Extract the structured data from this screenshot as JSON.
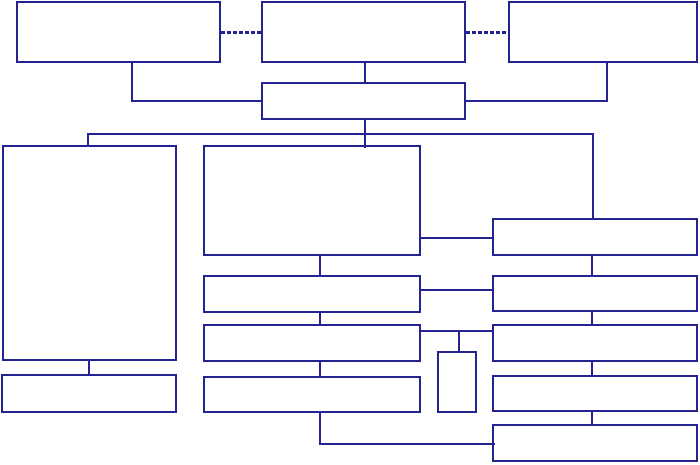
{
  "canvas": {
    "width": 700,
    "height": 465,
    "background_color": "#ffffff"
  },
  "style": {
    "stroke_color": "#232391",
    "box_fill_color": "#ffffff",
    "line_thickness": 2,
    "dash_thickness": 3,
    "dash_length": 4,
    "dash_gap": 2
  },
  "boxes": [
    {
      "name": "box-top-left",
      "x": 16,
      "y": 1,
      "w": 205,
      "h": 62
    },
    {
      "name": "box-top-middle",
      "x": 261,
      "y": 1,
      "w": 205,
      "h": 62
    },
    {
      "name": "box-top-right",
      "x": 508,
      "y": 1,
      "w": 190,
      "h": 62
    },
    {
      "name": "box-level2-center",
      "x": 261,
      "y": 82,
      "w": 205,
      "h": 38
    },
    {
      "name": "box-left-large",
      "x": 2,
      "y": 145,
      "w": 175,
      "h": 216
    },
    {
      "name": "box-left-bottom",
      "x": 1,
      "y": 374,
      "w": 176,
      "h": 39
    },
    {
      "name": "box-middle-large",
      "x": 203,
      "y": 145,
      "w": 218,
      "h": 111
    },
    {
      "name": "box-middle-2",
      "x": 203,
      "y": 275,
      "w": 218,
      "h": 38
    },
    {
      "name": "box-middle-3",
      "x": 203,
      "y": 324,
      "w": 218,
      "h": 38
    },
    {
      "name": "box-middle-4",
      "x": 203,
      "y": 376,
      "w": 218,
      "h": 37
    },
    {
      "name": "box-small-center",
      "x": 437,
      "y": 351,
      "w": 40,
      "h": 62
    },
    {
      "name": "box-right-1",
      "x": 492,
      "y": 218,
      "w": 206,
      "h": 38
    },
    {
      "name": "box-right-2",
      "x": 492,
      "y": 275,
      "w": 206,
      "h": 37
    },
    {
      "name": "box-right-3",
      "x": 492,
      "y": 324,
      "w": 206,
      "h": 38
    },
    {
      "name": "box-right-4",
      "x": 492,
      "y": 375,
      "w": 206,
      "h": 37
    },
    {
      "name": "box-right-5",
      "x": 492,
      "y": 424,
      "w": 206,
      "h": 38
    }
  ],
  "connectors": {
    "solid": [
      {
        "name": "connector-topleft-down",
        "x": 131,
        "y": 61,
        "w": 2,
        "h": 41
      },
      {
        "name": "connector-topleft-across",
        "x": 131,
        "y": 100,
        "w": 132,
        "h": 2
      },
      {
        "name": "connector-topmiddle-down",
        "x": 364,
        "y": 61,
        "w": 2,
        "h": 23
      },
      {
        "name": "connector-topright-down",
        "x": 606,
        "y": 61,
        "w": 2,
        "h": 41
      },
      {
        "name": "connector-topright-across",
        "x": 464,
        "y": 100,
        "w": 144,
        "h": 2
      },
      {
        "name": "connector-level2-down",
        "x": 364,
        "y": 118,
        "w": 2,
        "h": 30
      },
      {
        "name": "distribution-line",
        "x": 87,
        "y": 133,
        "w": 507,
        "h": 2
      },
      {
        "name": "drop-to-left-large",
        "x": 87,
        "y": 133,
        "w": 2,
        "h": 14
      },
      {
        "name": "drop-to-right-1",
        "x": 592,
        "y": 133,
        "w": 2,
        "h": 87
      },
      {
        "name": "link-middle-right-1",
        "x": 419,
        "y": 237,
        "w": 75,
        "h": 2
      },
      {
        "name": "link-middle-right-2",
        "x": 419,
        "y": 289,
        "w": 75,
        "h": 2
      },
      {
        "name": "link-middle-right-3",
        "x": 419,
        "y": 330,
        "w": 75,
        "h": 2
      },
      {
        "name": "drop-to-small-box",
        "x": 458,
        "y": 330,
        "w": 2,
        "h": 23
      },
      {
        "name": "connector-middle-1-2",
        "x": 319,
        "y": 254,
        "w": 2,
        "h": 23
      },
      {
        "name": "connector-middle-2-3",
        "x": 319,
        "y": 311,
        "w": 2,
        "h": 15
      },
      {
        "name": "connector-middle-3-4",
        "x": 319,
        "y": 360,
        "w": 2,
        "h": 18
      },
      {
        "name": "connector-right-1-2",
        "x": 591,
        "y": 254,
        "w": 2,
        "h": 23
      },
      {
        "name": "connector-right-2-3",
        "x": 591,
        "y": 310,
        "w": 2,
        "h": 16
      },
      {
        "name": "connector-right-3-4",
        "x": 591,
        "y": 360,
        "w": 2,
        "h": 17
      },
      {
        "name": "connector-right-4-5",
        "x": 591,
        "y": 410,
        "w": 2,
        "h": 16
      },
      {
        "name": "connector-middle4-down",
        "x": 319,
        "y": 411,
        "w": 2,
        "h": 34
      },
      {
        "name": "connector-bottom-across",
        "x": 319,
        "y": 443,
        "w": 176,
        "h": 2
      },
      {
        "name": "connector-left-large-down",
        "x": 88,
        "y": 359,
        "w": 2,
        "h": 17
      }
    ],
    "dashed": [
      {
        "name": "dashed-link-top-left",
        "x": 221,
        "y": 31,
        "w": 40
      },
      {
        "name": "dashed-link-top-right",
        "x": 466,
        "y": 31,
        "w": 42
      }
    ]
  }
}
